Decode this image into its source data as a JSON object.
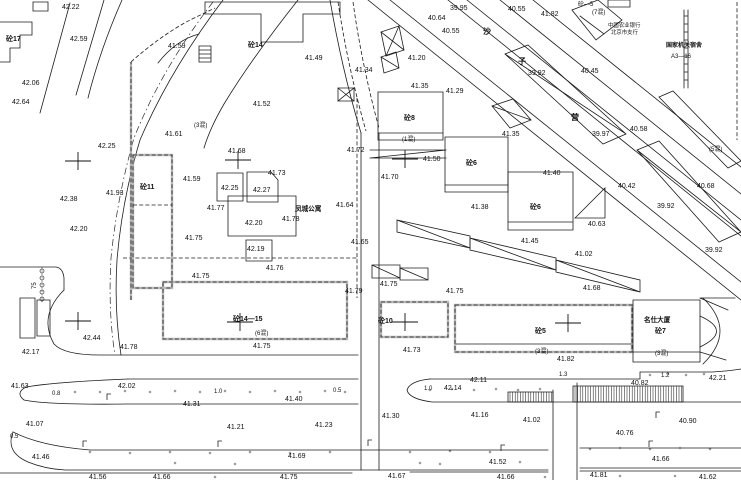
{
  "map": {
    "kind": "topographic cadastral site plan",
    "colors": {
      "ink": "#1c1c1c",
      "bg": "#ffffff",
      "slab_grey": "#bbbbbb"
    },
    "names": {
      "compound": "凤城公寓",
      "tower": "名仕大厦",
      "bank_line1": "中国农业银行",
      "bank_line2": "北京市支行",
      "agency_line1": "国家机关宿舍",
      "agency_line2": "A3—16",
      "street_chars": [
        "沙",
        "子",
        "营"
      ]
    },
    "labels": [
      [
        62,
        9,
        "42.22",
        ""
      ],
      [
        70,
        41,
        "42.59",
        ""
      ],
      [
        6,
        41,
        "砼17",
        "b"
      ],
      [
        22,
        85,
        "42.06",
        ""
      ],
      [
        12,
        104,
        "42.64",
        ""
      ],
      [
        98,
        148,
        "42.25",
        ""
      ],
      [
        60,
        201,
        "42.38",
        ""
      ],
      [
        70,
        231,
        "42.20",
        ""
      ],
      [
        106,
        195,
        "41.93",
        ""
      ],
      [
        140,
        189,
        "砼11",
        "b"
      ],
      [
        168,
        48,
        "41.59",
        ""
      ],
      [
        248,
        47,
        "砼14",
        "b"
      ],
      [
        305,
        60,
        "41.49",
        ""
      ],
      [
        253,
        106,
        "41.52",
        ""
      ],
      [
        194,
        127,
        "(3混)",
        "s6"
      ],
      [
        165,
        136,
        "41.61",
        ""
      ],
      [
        183,
        181,
        "41.59",
        ""
      ],
      [
        228,
        153,
        "41.68",
        ""
      ],
      [
        268,
        175,
        "41.73",
        ""
      ],
      [
        221,
        190,
        "42.25",
        ""
      ],
      [
        253,
        192,
        "42.27",
        ""
      ],
      [
        207,
        210,
        "41.77",
        ""
      ],
      [
        245,
        225,
        "42.20",
        ""
      ],
      [
        282,
        221,
        "41.78",
        ""
      ],
      [
        185,
        240,
        "41.75",
        ""
      ],
      [
        247,
        251,
        "42.19",
        ""
      ],
      [
        266,
        270,
        "41.76",
        ""
      ],
      [
        192,
        278,
        "41.75",
        ""
      ],
      [
        295,
        211,
        "凤城公寓",
        "n7"
      ],
      [
        336,
        207,
        "41.64",
        ""
      ],
      [
        351,
        244,
        "41.65",
        ""
      ],
      [
        345,
        293,
        "41.79",
        ""
      ],
      [
        380,
        286,
        "41.75",
        ""
      ],
      [
        347,
        152,
        "41.72",
        ""
      ],
      [
        381,
        179,
        "41.70",
        ""
      ],
      [
        355,
        72,
        "41.34",
        ""
      ],
      [
        428,
        20,
        "40.64",
        ""
      ],
      [
        442,
        33,
        "40.55",
        ""
      ],
      [
        450,
        10,
        "39.95",
        ""
      ],
      [
        508,
        11,
        "40.55",
        ""
      ],
      [
        541,
        16,
        "41.82",
        ""
      ],
      [
        578,
        6,
        "砼—5",
        "s6"
      ],
      [
        592,
        14,
        "(7混)",
        "s6"
      ],
      [
        608,
        27,
        "中国农业银行",
        "t"
      ],
      [
        611,
        34,
        "北京市支行",
        "t"
      ],
      [
        666,
        47,
        "国家机关宿舍",
        "t7"
      ],
      [
        671,
        58,
        "A3—16",
        "s6"
      ],
      [
        483,
        34,
        "沙",
        "n"
      ],
      [
        518,
        64,
        "子",
        "n"
      ],
      [
        571,
        120,
        "营",
        "n"
      ],
      [
        528,
        75,
        "39.92",
        ""
      ],
      [
        581,
        73,
        "40.45",
        ""
      ],
      [
        592,
        136,
        "39.97",
        ""
      ],
      [
        630,
        131,
        "40.58",
        ""
      ],
      [
        709,
        151,
        "(5混)",
        "s6"
      ],
      [
        618,
        188,
        "40.42",
        ""
      ],
      [
        697,
        188,
        "40.68",
        ""
      ],
      [
        657,
        208,
        "39.92",
        ""
      ],
      [
        588,
        226,
        "40.63",
        ""
      ],
      [
        705,
        252,
        "39.92",
        ""
      ],
      [
        408,
        60,
        "41.20",
        ""
      ],
      [
        411,
        88,
        "41.35",
        ""
      ],
      [
        446,
        93,
        "41.29",
        ""
      ],
      [
        404,
        120,
        "砼8",
        "b"
      ],
      [
        402,
        141,
        "(1混)",
        "s6"
      ],
      [
        423,
        161,
        "41.50",
        ""
      ],
      [
        466,
        165,
        "砼6",
        "b"
      ],
      [
        502,
        136,
        "41.35",
        ""
      ],
      [
        543,
        175,
        "41.40",
        ""
      ],
      [
        471,
        209,
        "41.38",
        ""
      ],
      [
        530,
        209,
        "砼6",
        "b"
      ],
      [
        521,
        243,
        "41.45",
        ""
      ],
      [
        575,
        256,
        "41.02",
        ""
      ],
      [
        583,
        290,
        "41.68",
        ""
      ],
      [
        403,
        352,
        "41.73",
        ""
      ],
      [
        446,
        293,
        "41.75",
        ""
      ],
      [
        378,
        323,
        "砼10",
        "b"
      ],
      [
        233,
        321,
        "砼14—15",
        "b"
      ],
      [
        255,
        335,
        "(6混)",
        "s6"
      ],
      [
        253,
        348,
        "41.75",
        ""
      ],
      [
        535,
        333,
        "砼5",
        "b"
      ],
      [
        535,
        353,
        "(3混)",
        "s6"
      ],
      [
        557,
        361,
        "41.82",
        ""
      ],
      [
        655,
        355,
        "(3混)",
        "s6"
      ],
      [
        644,
        322,
        "名仕大厦",
        "s7b"
      ],
      [
        655,
        333,
        "砼7",
        "b"
      ],
      [
        22,
        354,
        "42.17",
        ""
      ],
      [
        83,
        340,
        "42.44",
        ""
      ],
      [
        120,
        349,
        "41.78",
        ""
      ],
      [
        11,
        388,
        "41.63",
        ""
      ],
      [
        118,
        388,
        "42.02",
        ""
      ],
      [
        52,
        395,
        "0.8",
        "s6"
      ],
      [
        214,
        393,
        "1.0",
        "s6"
      ],
      [
        183,
        406,
        "41.31",
        ""
      ],
      [
        285,
        401,
        "41.40",
        ""
      ],
      [
        333,
        392,
        "0.5",
        "s6"
      ],
      [
        26,
        426,
        "41.07",
        ""
      ],
      [
        227,
        429,
        "41.21",
        ""
      ],
      [
        315,
        427,
        "41.23",
        ""
      ],
      [
        382,
        418,
        "41.30",
        ""
      ],
      [
        471,
        417,
        "41.16",
        ""
      ],
      [
        424,
        390,
        "1.0",
        "s6"
      ],
      [
        444,
        390,
        "42.14",
        ""
      ],
      [
        470,
        382,
        "42.11",
        ""
      ],
      [
        559,
        376,
        "1.3",
        "s6"
      ],
      [
        661,
        377,
        "1.2",
        "s6"
      ],
      [
        709,
        380,
        "42.21",
        ""
      ],
      [
        631,
        385,
        "40.82",
        ""
      ],
      [
        523,
        422,
        "41.02",
        ""
      ],
      [
        679,
        423,
        "40.90",
        ""
      ],
      [
        616,
        435,
        "40.76",
        ""
      ],
      [
        32,
        459,
        "41.46",
        ""
      ],
      [
        288,
        458,
        "41.69",
        ""
      ],
      [
        652,
        461,
        "41.66",
        ""
      ],
      [
        489,
        464,
        "41.52",
        ""
      ],
      [
        89,
        479,
        "41.56",
        ""
      ],
      [
        153,
        479,
        "41.66",
        ""
      ],
      [
        280,
        479,
        "41.75",
        ""
      ],
      [
        388,
        478,
        "41.67",
        ""
      ],
      [
        497,
        479,
        "41.66",
        ""
      ],
      [
        590,
        477,
        "41.81",
        ""
      ],
      [
        699,
        479,
        "41.62",
        ""
      ],
      [
        36,
        289,
        "75",
        "v"
      ],
      [
        10,
        438,
        "0.5",
        "s6"
      ]
    ],
    "paths": [
      {
        "d": "M223,0 Q170,70 140,140 Q122,200 117,260 Q114,310 121,355",
        "k": "s"
      },
      {
        "d": "M213,2 Q162,68 134,138 Q117,198 111,258 Q108,312 115,355",
        "k": "dd"
      },
      {
        "d": "M298,0 Q252,58 224,104 Q210,128 204,148",
        "k": "s"
      },
      {
        "d": "M70,3 L40,113",
        "k": "s"
      },
      {
        "d": "M104,0 L76,95",
        "k": "s"
      },
      {
        "d": "M122,0 Q100,50 88,98",
        "k": "s"
      },
      {
        "d": "M0,22 H32 V35 H20 V48 H10 V62 H0",
        "k": "s"
      },
      {
        "d": "M33,2 h15 v9 h-15 Z",
        "k": "s"
      },
      {
        "d": "M0,267 H56 Q63,268 64,278 V290",
        "k": "s"
      },
      {
        "d": "M64,290 Q38,316 54,344 Q64,355 100,355 H358",
        "k": "s"
      },
      {
        "d": "M20,298 h15 v40 h-15 Z",
        "k": "s"
      },
      {
        "d": "M37,300 h13 v36 h-13 Z",
        "k": "s"
      },
      {
        "d": "M42,267 V303",
        "k": "dt"
      },
      {
        "d": "M131,300 V62",
        "k": "slab"
      },
      {
        "d": "M131,62 Q160,36 190,20 L215,8",
        "k": "dash"
      },
      {
        "d": "M357,98 V298",
        "k": "dash"
      },
      {
        "d": "M123,258 H357",
        "k": "dash"
      },
      {
        "d": "M205,2 H340 V14 H303 V42 H261 V14 H205 Z",
        "k": "s"
      },
      {
        "d": "M158,63 Q176,40 199,34",
        "k": "s"
      },
      {
        "d": "M199,46 h12 v16 h-12 Z M199,50 h12 M199,54 h12 M199,58 h12",
        "k": "s"
      },
      {
        "d": "M133,155 h39 v133 h-39 Z",
        "k": "slab"
      },
      {
        "d": "M133,205 h39",
        "k": "dash"
      },
      {
        "d": "M217,173 h26 v28 h-26 Z",
        "k": "s"
      },
      {
        "d": "M247,172 h24 l7,8 v22 h-31 Z",
        "k": "s"
      },
      {
        "d": "M228,196 H296 V236 H228 Z",
        "k": "s"
      },
      {
        "d": "M246,240 h26 v21 h-26 Z",
        "k": "s"
      },
      {
        "d": "M163,282 H347 V339 H163 Z",
        "k": "slab"
      },
      {
        "d": "M381,302 H448 V337 H381 Z",
        "k": "slab"
      },
      {
        "d": "M455,305 H632 V352 H455 Z",
        "k": "slab"
      },
      {
        "d": "M456,344 H631",
        "k": "s"
      },
      {
        "d": "M361,133 V470",
        "k": "s"
      },
      {
        "d": "M379,133 V470",
        "k": "s"
      },
      {
        "d": "M330,0 Q342,70 361,133",
        "k": "s"
      },
      {
        "d": "M338,2 Q348,68 366,131",
        "k": "dash"
      },
      {
        "d": "M353,2 Q362,66 379,128",
        "k": "dash"
      },
      {
        "d": "M128,379 H358",
        "k": "s"
      },
      {
        "d": "M128,379 Q55,382 26,387 Q15,393 24,400 Q48,405 128,404 H358",
        "k": "s"
      },
      {
        "d": "M430,379 H640 V372 H712 Q730,371 741,369",
        "k": "s"
      },
      {
        "d": "M430,379 Q410,381 407,390 Q409,399 432,402 H741",
        "k": "s"
      },
      {
        "d": "M13,432 Q40,446 90,450 H548",
        "k": "s"
      },
      {
        "d": "M580,448 H741",
        "k": "s"
      },
      {
        "d": "M13,432 Q5,452 28,462 Q45,469 65,470 H548",
        "k": "s"
      },
      {
        "d": "M580,468 H741",
        "k": "s"
      },
      {
        "d": "M0,473 H352",
        "k": "s"
      },
      {
        "d": "M410,472 H548",
        "k": "s"
      },
      {
        "d": "M580,471 H741",
        "k": "s"
      },
      {
        "d": "M553,390 V480",
        "k": "s"
      },
      {
        "d": "M577,383 V480",
        "k": "s"
      },
      {
        "d": "M368,0 L741,300",
        "k": "s"
      },
      {
        "d": "M390,0 L741,282",
        "k": "s"
      },
      {
        "d": "M448,0 L741,236",
        "k": "s"
      },
      {
        "d": "M467,0 L741,220",
        "k": "s"
      },
      {
        "d": "M500,0 L741,194",
        "k": "s"
      },
      {
        "d": "M533,0 L741,167",
        "k": "s"
      },
      {
        "d": "M684,10 V88 M688,10 V88 M684,16 h4 M684,24 h4 M684,32 h4 M684,40 h4 M684,48 h4 M684,56 h4 M684,64 h4 M684,72 h4 M684,80 h4",
        "k": "s"
      },
      {
        "d": "M737,2 V140",
        "k": "dash"
      },
      {
        "d": "M572,10 L598,0 L622,20 L596,40 Z M580,16 L604,34",
        "k": "s"
      },
      {
        "d": "M608,0 h22 v7 h-22 Z",
        "k": "s"
      },
      {
        "d": "M505,54 L528,45 L626,134 L603,144 Z M505,54 L626,134",
        "k": "s"
      },
      {
        "d": "M637,150 L659,141 L741,232 L719,242 Z M637,150 L741,232",
        "k": "s"
      },
      {
        "d": "M659,97 L673,91 L741,161 L728,168 Z",
        "k": "s"
      },
      {
        "d": "M492,106 L513,99 L531,120 L510,128 Z M492,106 L531,120",
        "k": "s"
      },
      {
        "d": "M381,32 L399,26 L404,50 L386,56 Z M381,32 L404,50 M399,26 L386,56",
        "k": "s"
      },
      {
        "d": "M381,57 L396,52 L399,68 L384,73 Z M381,57 L399,68",
        "k": "s"
      },
      {
        "d": "M338,88 h16 v13 h-16 Z M338,88 l16,13 M354,88 l-16,13",
        "k": "s"
      },
      {
        "d": "M378,92 H443 V140 H378 Z M378,133 H443",
        "k": "s"
      },
      {
        "d": "M370,150 H446 M370,158 H446 M370,158 L446,150",
        "k": "s"
      },
      {
        "d": "M445,137 H508 V185 H445 Z M445,185 H508 V192 H445 Z",
        "k": "s"
      },
      {
        "d": "M508,172 H573 V222 H508 Z M508,222 H573 V230 H508 Z",
        "k": "s"
      },
      {
        "d": "M575,218 L605,188 L605,218 Z",
        "k": "s"
      },
      {
        "d": "M397,220 L470,236 L470,248 L397,232 Z M397,220 L470,248",
        "k": "s"
      },
      {
        "d": "M470,238 L556,258 L556,270 L470,250 Z M470,238 L556,270",
        "k": "s"
      },
      {
        "d": "M556,260 L640,280 L640,292 L556,272 Z M556,260 L640,292",
        "k": "s"
      },
      {
        "d": "M372,265 h28 v13 h-28 Z M372,265 l28,13",
        "k": "s"
      },
      {
        "d": "M400,268 h28 v12 h-28 Z M400,268 l28,12",
        "k": "s"
      },
      {
        "d": "M633,300 H700 V362 H633 Z M633,352 H700",
        "k": "s"
      },
      {
        "d": "M700,316 Q733,331 700,347",
        "k": "s"
      },
      {
        "d": "M703,298 Q737,331 703,364",
        "k": "s"
      },
      {
        "d": "M700,298 H735 M700,298 L728,310 M700,352 L726,360",
        "k": "s"
      }
    ],
    "hatch": [
      [
        508,
        392,
        45,
        10
      ],
      [
        573,
        386,
        110,
        16
      ]
    ],
    "crosses": [
      [
        78,
        161
      ],
      [
        238,
        160
      ],
      [
        405,
        159
      ],
      [
        78,
        321
      ],
      [
        240,
        322
      ],
      [
        405,
        322
      ],
      [
        568,
        323
      ]
    ],
    "fence_circles": [
      [
        42,
        271
      ],
      [
        42,
        278
      ],
      [
        42,
        285
      ],
      [
        42,
        292
      ],
      [
        42,
        299
      ]
    ],
    "dots": [
      [
        75,
        392
      ],
      [
        100,
        392
      ],
      [
        125,
        391
      ],
      [
        150,
        392
      ],
      [
        175,
        391
      ],
      [
        200,
        392
      ],
      [
        225,
        391
      ],
      [
        250,
        392
      ],
      [
        275,
        391
      ],
      [
        300,
        392
      ],
      [
        325,
        391
      ],
      [
        345,
        392
      ],
      [
        430,
        390
      ],
      [
        452,
        389
      ],
      [
        474,
        390
      ],
      [
        496,
        389
      ],
      [
        518,
        390
      ],
      [
        540,
        389
      ],
      [
        650,
        375
      ],
      [
        668,
        374
      ],
      [
        686,
        375
      ],
      [
        704,
        374
      ],
      [
        90,
        452
      ],
      [
        130,
        453
      ],
      [
        170,
        452
      ],
      [
        210,
        453
      ],
      [
        250,
        452
      ],
      [
        290,
        453
      ],
      [
        330,
        452
      ],
      [
        410,
        452
      ],
      [
        450,
        451
      ],
      [
        490,
        452
      ],
      [
        590,
        449
      ],
      [
        620,
        448
      ],
      [
        650,
        449
      ],
      [
        680,
        448
      ],
      [
        710,
        449
      ],
      [
        175,
        463
      ],
      [
        235,
        464
      ],
      [
        420,
        463
      ],
      [
        440,
        464
      ],
      [
        520,
        462
      ],
      [
        215,
        477
      ],
      [
        545,
        477
      ],
      [
        620,
        476
      ],
      [
        675,
        476
      ]
    ],
    "lamps": [
      [
        107,
        400
      ],
      [
        83,
        447
      ],
      [
        218,
        447
      ],
      [
        368,
        446
      ],
      [
        501,
        451
      ],
      [
        649,
        447
      ],
      [
        656,
        418
      ]
    ]
  }
}
